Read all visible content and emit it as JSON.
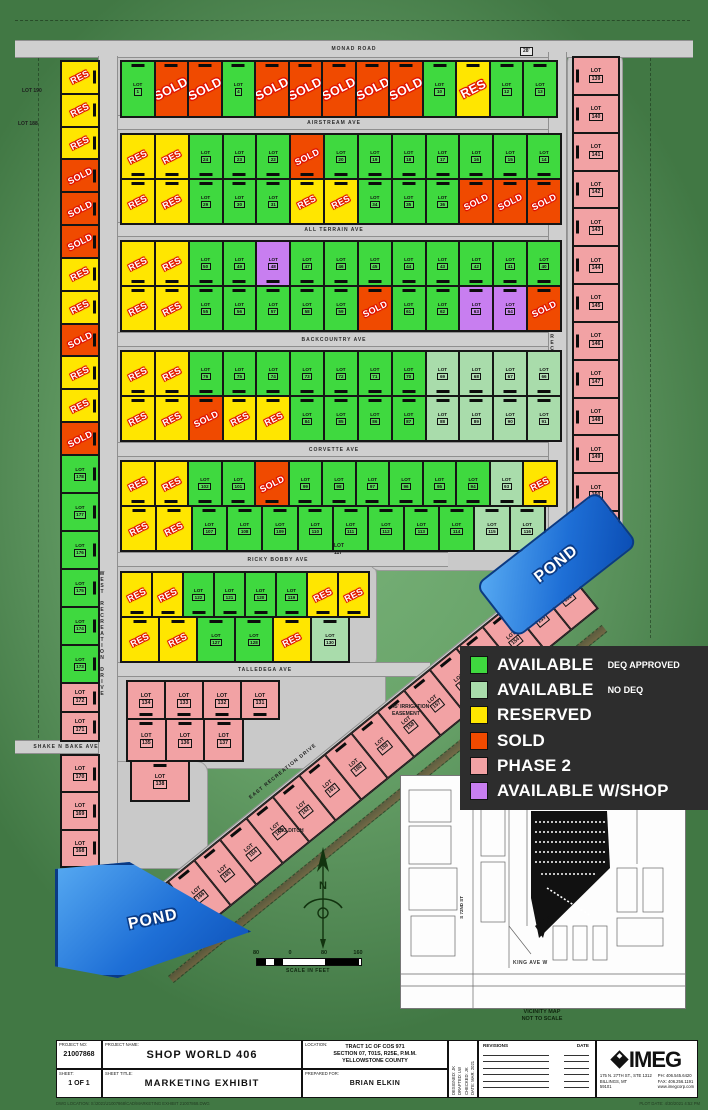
{
  "colors": {
    "available_deq": "#3fd93f",
    "available_nodeq": "#a9dcab",
    "reserved": "#ffe600",
    "sold": "#f04a00",
    "phase2": "#f2a2a4",
    "shop": "#c87ef0",
    "road": "#cfcfcf",
    "pond": "#1e6fd6",
    "legend_bg": "#2d2d2d"
  },
  "legend": {
    "items": [
      {
        "key": "available_deq",
        "label": "AVAILABLE",
        "sub": "DEQ APPROVED"
      },
      {
        "key": "available_nodeq",
        "label": "AVAILABLE",
        "sub": "NO DEQ"
      },
      {
        "key": "reserved",
        "label": "RESERVED",
        "sub": ""
      },
      {
        "key": "sold",
        "label": "SOLD",
        "sub": ""
      },
      {
        "key": "phase2",
        "label": "PHASE 2",
        "sub": ""
      },
      {
        "key": "shop",
        "label": "AVAILABLE W/SHOP",
        "sub": ""
      }
    ]
  },
  "map": {
    "pads": [
      {
        "x": 112,
        "y": 52,
        "w": 452,
        "h": 72
      },
      {
        "x": 112,
        "y": 126,
        "w": 458,
        "h": 104
      },
      {
        "x": 112,
        "y": 233,
        "w": 458,
        "h": 104
      },
      {
        "x": 112,
        "y": 343,
        "w": 458,
        "h": 104
      },
      {
        "x": 112,
        "y": 451,
        "w": 454,
        "h": 106
      },
      {
        "x": 112,
        "y": 564,
        "w": 264,
        "h": 104
      },
      {
        "x": 95,
        "y": 668,
        "w": 290,
        "h": 100
      },
      {
        "x": 95,
        "y": 762,
        "w": 112,
        "h": 106
      },
      {
        "x": 568,
        "y": 52,
        "w": 54,
        "h": 500
      },
      {
        "x": 370,
        "y": 540,
        "w": 196,
        "h": 30
      }
    ],
    "roads": [
      {
        "label": "MONAD ROAD",
        "x": 15,
        "y": 40,
        "w": 678,
        "h": 16
      },
      {
        "label": "AIRSTREAM AVE",
        "x": 108,
        "y": 115,
        "w": 452,
        "h": 13
      },
      {
        "label": "ALL TERRAIN AVE",
        "x": 108,
        "y": 222,
        "w": 452,
        "h": 13
      },
      {
        "label": "BACKCOUNTRY AVE",
        "x": 108,
        "y": 332,
        "w": 452,
        "h": 13
      },
      {
        "label": "CORVETTE AVE",
        "x": 108,
        "y": 442,
        "w": 452,
        "h": 13
      },
      {
        "label": "RICKY BOBBY AVE",
        "x": 108,
        "y": 552,
        "w": 340,
        "h": 13
      },
      {
        "label": "TALLEDEGA AVE",
        "x": 100,
        "y": 662,
        "w": 330,
        "h": 13
      },
      {
        "label": "SHAKE N BAKE AVE",
        "x": 15,
        "y": 740,
        "w": 102,
        "h": 12
      },
      {
        "label": "WEST RECREATION DRIVE",
        "x": 98,
        "y": 56,
        "w": 18,
        "h": 814,
        "vert": 1,
        "lp": 0.42
      },
      {
        "label": "EAST RECREATION DRIVE",
        "x": 548,
        "y": 52,
        "w": 17,
        "h": 516,
        "vert": 1,
        "lp": 0.22
      },
      {
        "label": "",
        "x": 128,
        "y": 910,
        "w": 562,
        "h": 16,
        "rot": -39
      }
    ],
    "strips": [
      {
        "x": 120,
        "y": 60,
        "w": 436,
        "h": 56,
        "e": "t",
        "big": 1,
        "cells": [
          [
            1,
            "A"
          ],
          [
            2,
            "S"
          ],
          [
            3,
            "S"
          ],
          [
            4,
            "A"
          ],
          [
            5,
            "S"
          ],
          [
            6,
            "S"
          ],
          [
            7,
            "S"
          ],
          [
            8,
            "S"
          ],
          [
            9,
            "S"
          ],
          [
            10,
            "A"
          ],
          [
            11,
            "R"
          ],
          [
            12,
            "A"
          ],
          [
            13,
            "A"
          ]
        ]
      },
      {
        "x": 120,
        "y": 133,
        "w": 440,
        "h": 45,
        "e": "b",
        "cells": [
          [
            26,
            "R"
          ],
          [
            25,
            "R"
          ],
          [
            24,
            "A"
          ],
          [
            23,
            "A"
          ],
          [
            22,
            "A"
          ],
          [
            21,
            "S"
          ],
          [
            20,
            "A"
          ],
          [
            19,
            "A"
          ],
          [
            18,
            "A"
          ],
          [
            17,
            "A"
          ],
          [
            16,
            "A"
          ],
          [
            15,
            "A"
          ],
          [
            14,
            "A"
          ]
        ]
      },
      {
        "x": 120,
        "y": 178,
        "w": 440,
        "h": 45,
        "e": "t",
        "cells": [
          [
            27,
            "R"
          ],
          [
            28,
            "R"
          ],
          [
            29,
            "A"
          ],
          [
            30,
            "A"
          ],
          [
            31,
            "A"
          ],
          [
            32,
            "R"
          ],
          [
            33,
            "R"
          ],
          [
            34,
            "A"
          ],
          [
            35,
            "A"
          ],
          [
            36,
            "A"
          ],
          [
            37,
            "S"
          ],
          [
            38,
            "S"
          ],
          [
            39,
            "S"
          ]
        ]
      },
      {
        "x": 120,
        "y": 240,
        "w": 440,
        "h": 45,
        "e": "b",
        "cells": [
          [
            52,
            "R"
          ],
          [
            51,
            "R"
          ],
          [
            50,
            "A"
          ],
          [
            49,
            "A"
          ],
          [
            48,
            "W"
          ],
          [
            47,
            "A"
          ],
          [
            46,
            "A"
          ],
          [
            45,
            "A"
          ],
          [
            44,
            "A"
          ],
          [
            43,
            "A"
          ],
          [
            42,
            "A"
          ],
          [
            41,
            "A"
          ],
          [
            40,
            "A"
          ]
        ]
      },
      {
        "x": 120,
        "y": 285,
        "w": 440,
        "h": 45,
        "e": "t",
        "cells": [
          [
            53,
            "R"
          ],
          [
            54,
            "R"
          ],
          [
            55,
            "A"
          ],
          [
            56,
            "A"
          ],
          [
            57,
            "A"
          ],
          [
            58,
            "A"
          ],
          [
            59,
            "A"
          ],
          [
            60,
            "S"
          ],
          [
            61,
            "A"
          ],
          [
            62,
            "A"
          ],
          [
            63,
            "W"
          ],
          [
            64,
            "W"
          ],
          [
            65,
            "S"
          ]
        ]
      },
      {
        "x": 120,
        "y": 350,
        "w": 440,
        "h": 45,
        "e": "b",
        "cells": [
          [
            78,
            "R"
          ],
          [
            77,
            "R"
          ],
          [
            76,
            "A"
          ],
          [
            75,
            "A"
          ],
          [
            74,
            "A"
          ],
          [
            73,
            "A"
          ],
          [
            72,
            "A"
          ],
          [
            71,
            "A"
          ],
          [
            70,
            "A"
          ],
          [
            69,
            "N"
          ],
          [
            68,
            "N"
          ],
          [
            67,
            "N"
          ],
          [
            66,
            "N"
          ]
        ]
      },
      {
        "x": 120,
        "y": 395,
        "w": 440,
        "h": 45,
        "e": "t",
        "cells": [
          [
            79,
            "R"
          ],
          [
            80,
            "R"
          ],
          [
            81,
            "S"
          ],
          [
            82,
            "R"
          ],
          [
            83,
            "R"
          ],
          [
            84,
            "A"
          ],
          [
            85,
            "A"
          ],
          [
            86,
            "A"
          ],
          [
            87,
            "A"
          ],
          [
            88,
            "N"
          ],
          [
            89,
            "N"
          ],
          [
            90,
            "N"
          ],
          [
            91,
            "N"
          ]
        ]
      },
      {
        "x": 120,
        "y": 460,
        "w": 436,
        "h": 45,
        "e": "b",
        "cells": [
          [
            104,
            "R"
          ],
          [
            103,
            "R"
          ],
          [
            102,
            "A"
          ],
          [
            101,
            "A"
          ],
          [
            100,
            "S"
          ],
          [
            99,
            "A"
          ],
          [
            98,
            "A"
          ],
          [
            97,
            "A"
          ],
          [
            96,
            "A"
          ],
          [
            95,
            "A"
          ],
          [
            94,
            "A"
          ],
          [
            93,
            "N"
          ],
          [
            92,
            "R"
          ]
        ]
      },
      {
        "x": 120,
        "y": 505,
        "w": 424,
        "h": 45,
        "e": "t",
        "cells": [
          [
            105,
            "R"
          ],
          [
            106,
            "R"
          ],
          [
            107,
            "A"
          ],
          [
            108,
            "A"
          ],
          [
            109,
            "A"
          ],
          [
            110,
            "A"
          ],
          [
            111,
            "A"
          ],
          [
            112,
            "A"
          ],
          [
            113,
            "A"
          ],
          [
            114,
            "A"
          ],
          [
            115,
            "N"
          ],
          [
            116,
            "N"
          ]
        ]
      },
      {
        "x": 120,
        "y": 571,
        "w": 248,
        "h": 45,
        "e": "b",
        "cells": [
          [
            124,
            "R"
          ],
          [
            123,
            "R"
          ],
          [
            122,
            "A"
          ],
          [
            121,
            "A"
          ],
          [
            120,
            "A"
          ],
          [
            119,
            "A"
          ],
          [
            118,
            "R"
          ],
          [
            117,
            "R"
          ]
        ]
      },
      {
        "x": 120,
        "y": 616,
        "w": 228,
        "h": 45,
        "e": "t",
        "cells": [
          [
            125,
            "R"
          ],
          [
            126,
            "R"
          ],
          [
            127,
            "A"
          ],
          [
            128,
            "A"
          ],
          [
            129,
            "R"
          ],
          [
            130,
            "N"
          ]
        ]
      },
      {
        "x": 60,
        "y": 60,
        "w": 38,
        "h": 394,
        "vert": 1,
        "e": "r",
        "cells": [
          [
            190,
            "R"
          ],
          [
            189,
            "R"
          ],
          [
            188,
            "R"
          ],
          [
            187,
            "S"
          ],
          [
            186,
            "S"
          ],
          [
            185,
            "S"
          ],
          [
            184,
            "R"
          ],
          [
            183,
            "R"
          ],
          [
            182,
            "S"
          ],
          [
            181,
            "R"
          ],
          [
            180,
            "R"
          ],
          [
            179,
            "S"
          ]
        ]
      },
      {
        "x": 60,
        "y": 454,
        "w": 38,
        "h": 228,
        "vert": 1,
        "e": "r",
        "cells": [
          [
            178,
            "A"
          ],
          [
            177,
            "A"
          ],
          [
            176,
            "A"
          ],
          [
            175,
            "A"
          ],
          [
            174,
            "A"
          ],
          [
            173,
            "A"
          ]
        ]
      },
      {
        "x": 60,
        "y": 682,
        "w": 38,
        "h": 58,
        "vert": 1,
        "e": "r",
        "cells": [
          [
            172,
            "P"
          ],
          [
            171,
            "P"
          ]
        ]
      },
      {
        "x": 60,
        "y": 754,
        "w": 38,
        "h": 112,
        "vert": 1,
        "e": "r",
        "cells": [
          [
            170,
            "P"
          ],
          [
            169,
            "P"
          ],
          [
            168,
            "P"
          ]
        ]
      },
      {
        "x": 572,
        "y": 56,
        "w": 46,
        "h": 492,
        "vert": 1,
        "e": "l",
        "cells": [
          [
            139,
            "P"
          ],
          [
            140,
            "P"
          ],
          [
            141,
            "P"
          ],
          [
            142,
            "P"
          ],
          [
            143,
            "P"
          ],
          [
            144,
            "P"
          ],
          [
            145,
            "P"
          ],
          [
            146,
            "P"
          ],
          [
            147,
            "P"
          ],
          [
            148,
            "P"
          ],
          [
            149,
            "P"
          ],
          [
            150,
            "P"
          ],
          [
            151,
            "P"
          ]
        ]
      },
      {
        "x": 126,
        "y": 680,
        "w": 152,
        "h": 38,
        "e": "b",
        "cells": [
          [
            134,
            "P"
          ],
          [
            133,
            "P"
          ],
          [
            132,
            "P"
          ],
          [
            131,
            "P"
          ]
        ]
      },
      {
        "x": 126,
        "y": 718,
        "w": 116,
        "h": 42,
        "e": "t",
        "cells": [
          [
            135,
            "P"
          ],
          [
            136,
            "P"
          ],
          [
            137,
            "P"
          ]
        ]
      },
      {
        "x": 130,
        "y": 760,
        "w": 58,
        "h": 40,
        "e": "t",
        "cells": [
          [
            138,
            "P"
          ]
        ]
      },
      {
        "x": 140,
        "y": 903,
        "w": 540,
        "h": 58,
        "rot": -39,
        "e": "t",
        "cells": [
          [
            167,
            "P"
          ],
          [
            166,
            "P"
          ],
          [
            165,
            "P"
          ],
          [
            164,
            "P"
          ],
          [
            163,
            "P"
          ],
          [
            162,
            "P"
          ],
          [
            161,
            "P"
          ],
          [
            160,
            "P"
          ],
          [
            159,
            "P"
          ],
          [
            158,
            "P"
          ],
          [
            157,
            "P"
          ],
          [
            156,
            "P"
          ],
          [
            155,
            "P"
          ],
          [
            154,
            "P"
          ],
          [
            153,
            "P"
          ],
          [
            152,
            "P"
          ]
        ]
      }
    ],
    "annotations": [
      {
        "t": "LOT 190",
        "x": 22,
        "y": 88
      },
      {
        "t": "LOT 188",
        "x": 18,
        "y": 121
      },
      {
        "t": "28'",
        "x": 520,
        "y": 47,
        "box": 1
      },
      {
        "t": "LOT\n117",
        "x": 334,
        "y": 543
      },
      {
        "t": "45' IRRIGATION\nEASEMENT",
        "x": 392,
        "y": 704
      },
      {
        "t": "BIG DITCH",
        "x": 278,
        "y": 828
      },
      {
        "t": "EAST RECREATION DRIVE",
        "x": 248,
        "y": 796,
        "rot": -39
      }
    ],
    "ponds": [
      {
        "label": "POND"
      },
      {
        "label": "POND"
      }
    ],
    "scale": {
      "ticks": [
        "80",
        "0",
        "80",
        "160"
      ],
      "caption": "SCALE IN FEET"
    },
    "compass_label": "N",
    "vicinity": {
      "street_h": "KING AVE W",
      "street_v": "S 72ND ST",
      "caption": "VICINITY MAP\nNOT TO SCALE"
    }
  },
  "titleblock": {
    "project_no_label": "PROJECT NO:",
    "project_no": "21007868",
    "project_name_label": "PROJECT NAME:",
    "project_name": "SHOP WORLD 406",
    "location_label": "LOCATION:",
    "location_lines": [
      "TRACT 1C OF COS 971",
      "SECTION 07, T01S, R25E, P.M.M.",
      "YELLOWSTONE COUNTY"
    ],
    "sheet_label": "SHEET:",
    "sheet": "1 OF 1",
    "sheet_title_label": "SHEET TITLE:",
    "sheet_title": "MARKETING EXHIBIT",
    "prepared_label": "PREPARED FOR:",
    "prepared": "BRIAN ELKIN",
    "fields": [
      {
        "label": "DESIGNED:",
        "value": "JK"
      },
      {
        "label": "DRAFTED:",
        "value": "LW"
      },
      {
        "label": "CHECKED:",
        "value": "JK"
      },
      {
        "label": "DATE:",
        "value": "MAR. 2021"
      }
    ],
    "revisions_label": "REVISIONS",
    "rev_date_label": "DATE",
    "revision_rows": 6,
    "imeg": {
      "name": "IMEG",
      "address": [
        "175 N. 27TH ST., STE 1312",
        "BILLINGS, MT",
        "59101"
      ],
      "contact": [
        "PH: 406.545.6420",
        "FAX: 406.256.1191",
        "www.imegcorp.com"
      ]
    },
    "plot_note": "PLOT DATE: 4/30/2021 4:52 PM",
    "dwg_note": "DWG LOCATION: S:\\2021\\21007868\\CAD\\MARKETING EXHIBIT 21007868.DWG"
  }
}
